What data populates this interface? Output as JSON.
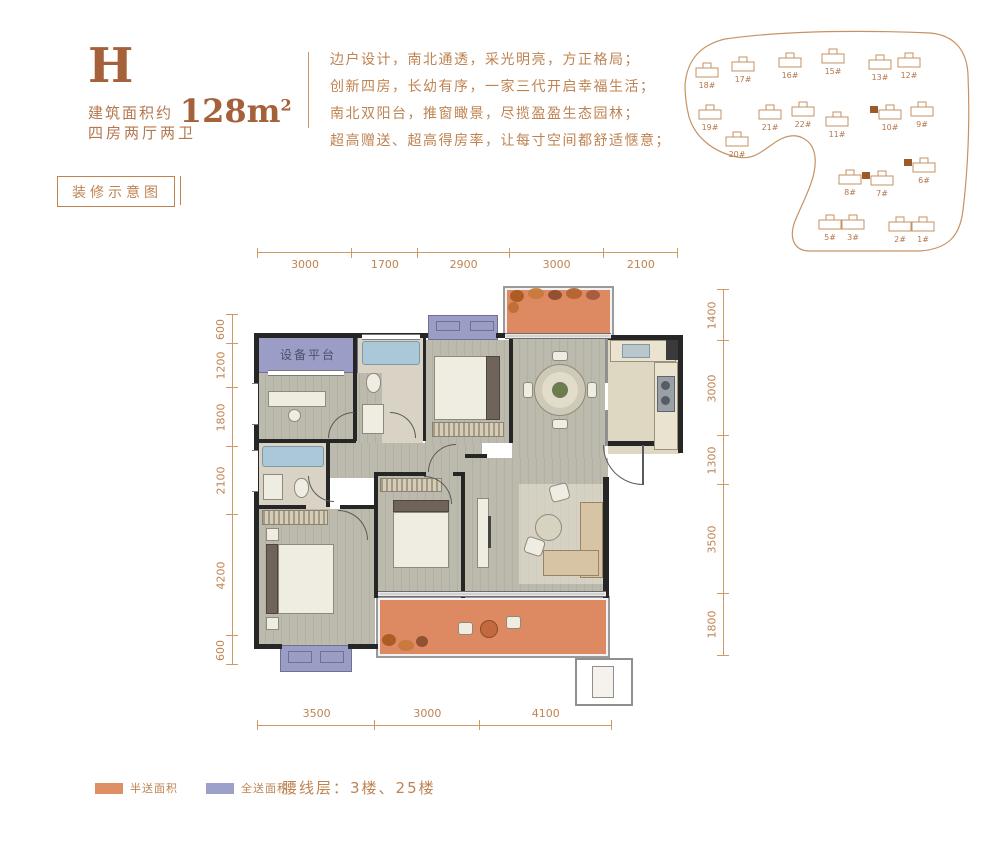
{
  "header": {
    "unit": "H",
    "area_prefix": "建筑面积约",
    "area_value": "128m",
    "area_sup": "2",
    "layout": "四房两厅两卫",
    "tag": "装修示意图"
  },
  "description": {
    "line1": "边户设计，南北通透，采光明亮，方正格局；",
    "line2": "创新四房，长幼有序，一家三代开启幸福生活；",
    "line3": "南北双阳台，推窗瞰景，尽揽盈盈生态园林；",
    "line4": "超高赠送、超高得房率，让每寸空间都舒适惬意；"
  },
  "site_plan": {
    "buildings": [
      {
        "label": "18#",
        "x": 32,
        "y": 48,
        "marked": false
      },
      {
        "label": "17#",
        "x": 68,
        "y": 42,
        "marked": false
      },
      {
        "label": "16#",
        "x": 115,
        "y": 38,
        "marked": false
      },
      {
        "label": "15#",
        "x": 158,
        "y": 34,
        "marked": false
      },
      {
        "label": "13#",
        "x": 205,
        "y": 40,
        "marked": false
      },
      {
        "label": "12#",
        "x": 234,
        "y": 38,
        "marked": false
      },
      {
        "label": "19#",
        "x": 35,
        "y": 90,
        "marked": false
      },
      {
        "label": "21#",
        "x": 95,
        "y": 90,
        "marked": false
      },
      {
        "label": "22#",
        "x": 128,
        "y": 87,
        "marked": false
      },
      {
        "label": "11#",
        "x": 162,
        "y": 97,
        "marked": false
      },
      {
        "label": "10#",
        "x": 215,
        "y": 90,
        "marked": true
      },
      {
        "label": "9#",
        "x": 247,
        "y": 87,
        "marked": false
      },
      {
        "label": "20#",
        "x": 62,
        "y": 117,
        "marked": false
      },
      {
        "label": "8#",
        "x": 175,
        "y": 155,
        "marked": false
      },
      {
        "label": "7#",
        "x": 207,
        "y": 156,
        "marked": true
      },
      {
        "label": "6#",
        "x": 249,
        "y": 143,
        "marked": true
      },
      {
        "label": "5#",
        "x": 155,
        "y": 200,
        "marked": false
      },
      {
        "label": "3#",
        "x": 178,
        "y": 200,
        "marked": false
      },
      {
        "label": "2#",
        "x": 225,
        "y": 202,
        "marked": false
      },
      {
        "label": "1#",
        "x": 248,
        "y": 202,
        "marked": false
      }
    ]
  },
  "floor_plan": {
    "labels": {
      "equipment_platform": "设备平台"
    },
    "dims": {
      "top": [
        3000,
        1700,
        2900,
        3000,
        2100
      ],
      "bottom": [
        3500,
        3000,
        4100
      ],
      "left": [
        600,
        1200,
        1800,
        2100,
        4200,
        600
      ],
      "right": [
        1400,
        3000,
        1300,
        3500,
        1800
      ]
    }
  },
  "legend": {
    "half_gift": "半送面积",
    "full_gift": "全送面积",
    "half_color": "#df8f66",
    "full_color": "#9da0c9",
    "waistline": "腰线层：3楼、25楼"
  },
  "colors": {
    "accent_text": "#bf8352",
    "title": "#a5613a",
    "dim_line": "#cf9a63",
    "wall": "#262626",
    "half_gift_area": "#dd8a63",
    "full_gift_area": "#9b9dc6"
  }
}
